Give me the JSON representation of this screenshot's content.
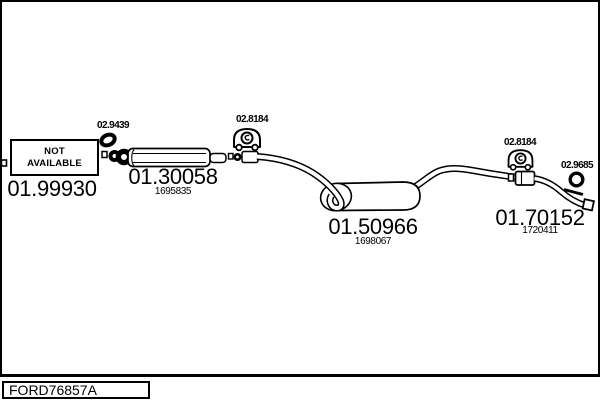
{
  "frame": {
    "code_label": "FORD76857A"
  },
  "parts": {
    "front_pipe": {
      "number": "01.99930",
      "availability": {
        "line1": "NOT",
        "line2": "AVAILABLE"
      }
    },
    "center_silencer": {
      "number": "01.30058",
      "ref": "1695835"
    },
    "rear_muffler": {
      "number": "01.50966",
      "ref": "1698067"
    },
    "tail_pipe": {
      "number": "01.70152",
      "ref": "1720411"
    }
  },
  "fittings": {
    "gasket": {
      "number": "02.9439"
    },
    "hanger_front": {
      "number": "02.8184"
    },
    "hanger_rear": {
      "number": "02.8184"
    },
    "grommet": {
      "number": "02.9685"
    }
  },
  "colors": {
    "ink": "#000000",
    "paper": "#ffffff"
  }
}
